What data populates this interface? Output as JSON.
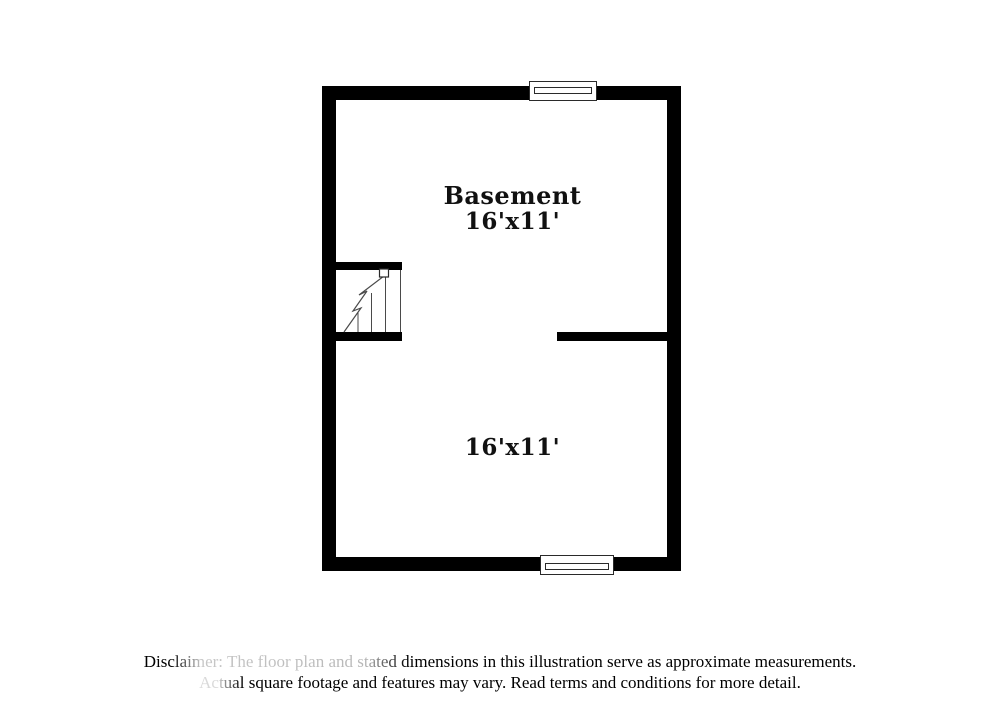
{
  "floor_plan": {
    "title": "Basement floor plan",
    "wall_color": "#000000",
    "background_color": "#ffffff",
    "stair_line_color": "#4a4a4a",
    "rooms": [
      {
        "name": "Basement",
        "dimensions": "16'x11'"
      },
      {
        "name": "",
        "dimensions": "16'x11'"
      }
    ],
    "features": [
      "window-top",
      "window-bottom",
      "staircase",
      "interior-wall"
    ]
  },
  "disclaimer": {
    "line1": "Disclaimer: The floor plan and stated dimensions in this illustration serve as approximate measurements.",
    "line2": "Actual square footage and features may vary. Read terms and conditions for more detail."
  }
}
